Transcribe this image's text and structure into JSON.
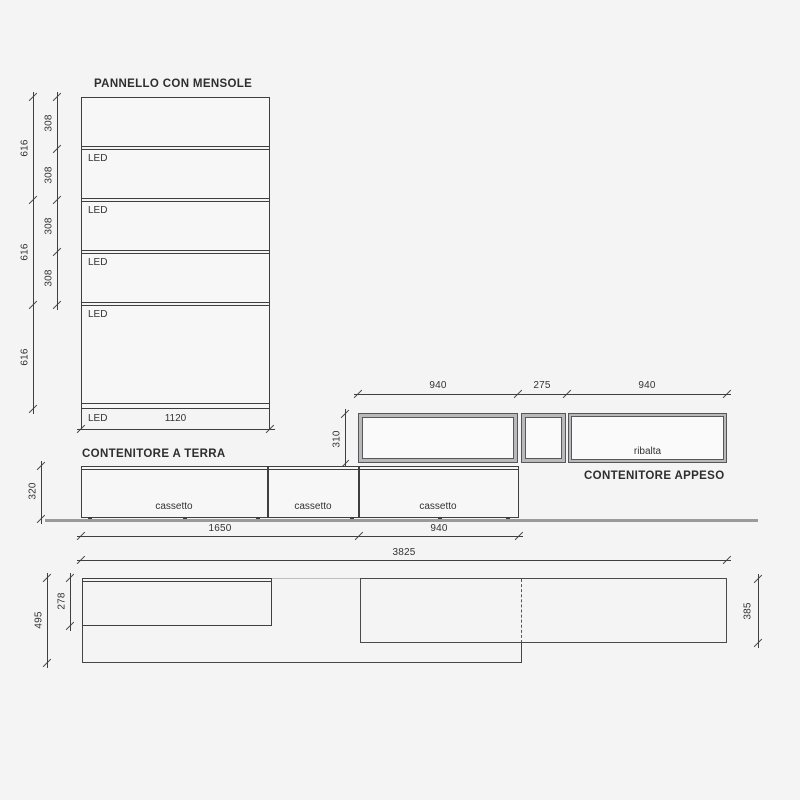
{
  "colors": {
    "background": "#f4f4f4",
    "line": "#3f3f3f",
    "floor_gray": "#9a9a9a",
    "frame_gray": "#b9b9b9"
  },
  "panel": {
    "title": "PANNELLO CON MENSOLE",
    "led_label": "LED",
    "width_dim": "1120",
    "shelf_dims": [
      "308",
      "308",
      "308",
      "308"
    ],
    "column_dims": [
      "616",
      "616",
      "616"
    ]
  },
  "floor_unit": {
    "title": "CONTENITORE A TERRA",
    "height_dim": "320",
    "drawers": [
      "cassetto",
      "cassetto",
      "cassetto"
    ],
    "width_dim_left": "1650",
    "width_dim_right": "940",
    "total_width_dim": "3825"
  },
  "wall_unit": {
    "title": "CONTENITORE APPESO",
    "top_dims": [
      "940",
      "275",
      "940"
    ],
    "height_dim": "310",
    "flap_label": "ribalta"
  },
  "plan_view": {
    "total_depth_dim": "495",
    "panel_depth_dim": "278",
    "wall_unit_depth_dim": "385"
  }
}
